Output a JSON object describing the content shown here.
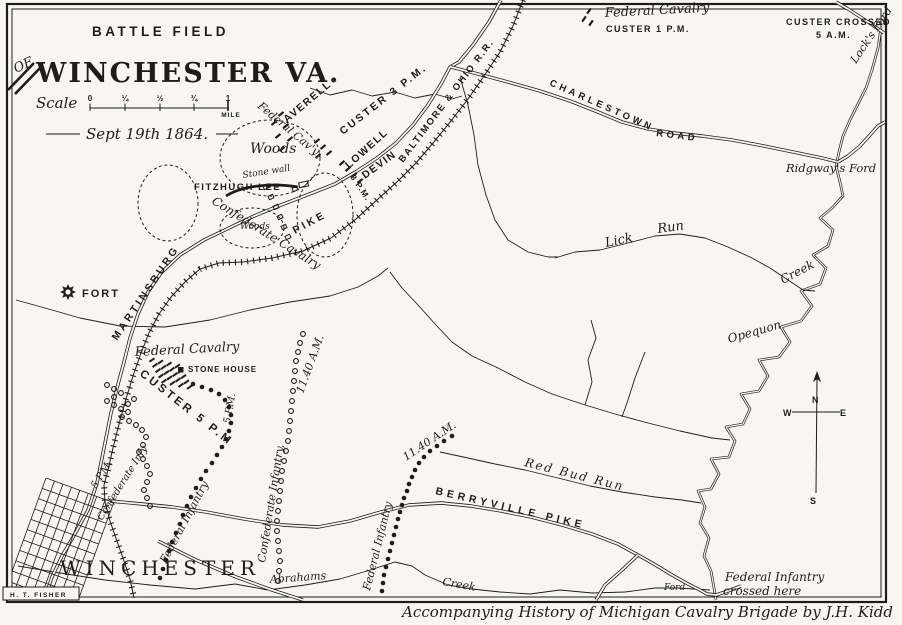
{
  "colors": {
    "ink": "#1e1d19",
    "paper": "#f7f6f1"
  },
  "scale": {
    "word": "Scale",
    "ticks": [
      "0",
      "¼",
      "½",
      "¾",
      "1"
    ],
    "unit": "MILE",
    "date": "Sept 19th 1864."
  },
  "compass": {
    "n": "N",
    "e": "E",
    "s": "S",
    "w": "W"
  },
  "map_labels": {
    "header": [
      {
        "id": "title-battle-field",
        "t": "BATTLE FIELD",
        "x": 92,
        "y": 36,
        "c": "cap",
        "s": 13.5,
        "ls": 3.5
      },
      {
        "id": "title-of",
        "t": "OF",
        "x": 16,
        "y": 73,
        "r": -25,
        "c": "scr",
        "s": 13
      },
      {
        "id": "title-winchester-va",
        "t": "WINCHESTER VA.",
        "x": 36,
        "y": 82,
        "c": "ornate",
        "s": 27,
        "ls": 2
      }
    ],
    "top_right": [
      {
        "id": "federal-cavalry-1pm",
        "t": "Federal Cavalry",
        "x": 605,
        "y": 17,
        "r": -3,
        "c": "scr",
        "s": 13
      },
      {
        "id": "custer-1pm",
        "t": "CUSTER  1 P.M.",
        "x": 606,
        "y": 32,
        "c": "cap",
        "s": 9,
        "ls": 1.5
      },
      {
        "id": "custer-crossed",
        "t": "CUSTER CROSSED",
        "x": 786,
        "y": 25,
        "c": "cap",
        "s": 9,
        "ls": 1.5
      },
      {
        "id": "custer-crossed-time",
        "t": "5 A.M.",
        "x": 816,
        "y": 38,
        "c": "cap",
        "s": 9,
        "ls": 1.5
      },
      {
        "id": "locks-ford",
        "t": "Lock's Ford",
        "x": 856,
        "y": 64,
        "r": -56,
        "c": "scr",
        "s": 11
      }
    ],
    "roads": [
      {
        "id": "charlestown",
        "t": "CHARLESTOWN",
        "x": 549,
        "y": 85,
        "r": 24,
        "c": "cap",
        "s": 9.5,
        "ls": 3.5
      },
      {
        "id": "charlestown-road",
        "t": "ROAD",
        "x": 656,
        "y": 136,
        "r": 7,
        "c": "cap",
        "s": 9.5,
        "ls": 3.5
      },
      {
        "id": "ridgways-ford",
        "t": "Ridgway's Ford",
        "x": 786,
        "y": 172,
        "c": "scr",
        "s": 11.5
      },
      {
        "id": "baltimore-ohio-rr",
        "t": "BALTIMORE & OHIO R.R.",
        "x": 403,
        "y": 163,
        "r": -53,
        "c": "cap",
        "s": 9.5,
        "ls": 1.8
      },
      {
        "id": "martinsburg",
        "t": "MARTINSBURG",
        "x": 117,
        "y": 341,
        "r": -56,
        "c": "cap",
        "s": 10.5,
        "ls": 3
      },
      {
        "id": "pike",
        "t": "PIKE",
        "x": 295,
        "y": 234,
        "r": -28,
        "c": "cap",
        "s": 10.5,
        "ls": 3
      },
      {
        "id": "berryville-pike",
        "t": "BERRYVILLE  PIKE",
        "x": 435,
        "y": 494,
        "r": 13,
        "c": "cap",
        "s": 10.5,
        "ls": 4
      }
    ],
    "federal_positions": [
      {
        "id": "custer-3pm",
        "t": "CUSTER 3 P.M.",
        "x": 343,
        "y": 135,
        "r": -38,
        "c": "cap",
        "s": 10.5,
        "ls": 2.5
      },
      {
        "id": "averell",
        "t": "AVERELL",
        "x": 287,
        "y": 123,
        "r": -40,
        "c": "cap",
        "s": 10.5,
        "ls": 1.5
      },
      {
        "id": "federal-cavy",
        "t": "Federal Cav'y",
        "x": 257,
        "y": 107,
        "r": 40,
        "c": "scr",
        "s": 11
      },
      {
        "id": "lowell",
        "t": "LOWELL",
        "x": 349,
        "y": 169,
        "r": -42,
        "c": "cap",
        "s": 10.5,
        "ls": 1.5
      },
      {
        "id": "devin",
        "t": "DEVIN",
        "x": 365,
        "y": 179,
        "r": -36,
        "c": "cap",
        "s": 10.5,
        "ls": 1.5
      },
      {
        "id": "three-pm",
        "t": "3 P.M.",
        "x": 350,
        "y": 177,
        "r": 56,
        "c": "cap",
        "s": 8.5,
        "ls": 1
      },
      {
        "id": "federal-cavalry-5pm",
        "t": "Federal Cavalry",
        "x": 135,
        "y": 356,
        "r": -3,
        "c": "scr",
        "s": 13
      },
      {
        "id": "custer-5pm",
        "t": "CUSTER 5 P.M",
        "x": 139,
        "y": 375,
        "r": 38,
        "c": "cap",
        "s": 11.5,
        "ls": 3
      },
      {
        "id": "fed-5pm-time",
        "t": "5 P.M.",
        "x": 230,
        "y": 424,
        "r": -80,
        "c": "scr",
        "s": 10
      },
      {
        "id": "fed-inf-5pm",
        "t": "Federal Infantry",
        "x": 166,
        "y": 564,
        "r": -62,
        "c": "scr",
        "s": 11
      },
      {
        "id": "fed-inf-1140",
        "t": "Federal Infantry",
        "x": 370,
        "y": 591,
        "r": -76,
        "c": "scr",
        "s": 11
      },
      {
        "id": "fed-1140-time",
        "t": "11.40 A.M.",
        "x": 406,
        "y": 461,
        "r": -34,
        "c": "scr",
        "s": 11
      },
      {
        "id": "fed-crossed-1",
        "t": "Federal Infantry",
        "x": 725,
        "y": 581,
        "c": "scr",
        "s": 12
      },
      {
        "id": "fed-crossed-2",
        "t": "crossed here",
        "x": 723,
        "y": 595,
        "c": "scr",
        "s": 12
      }
    ],
    "confederate_positions": [
      {
        "id": "fitzhugh-lee",
        "t": "FITZHUGH LEE",
        "x": 194,
        "y": 190,
        "c": "cap",
        "s": 9.5,
        "ls": 1.5
      },
      {
        "id": "confederate-cavalry",
        "t": "Confederate Cavalry",
        "x": 211,
        "y": 203,
        "r": 32,
        "c": "scr",
        "s": 12
      },
      {
        "id": "conf-5pm-time",
        "t": "5 P.M.",
        "x": 96,
        "y": 489,
        "r": -58,
        "c": "scr",
        "s": 10
      },
      {
        "id": "conf-5pm",
        "t": "Confederate Infy",
        "x": 102,
        "y": 521,
        "r": -58,
        "c": "scr",
        "s": 10
      },
      {
        "id": "conf-inf-1140",
        "t": "Confederate Infantry,",
        "x": 265,
        "y": 563,
        "r": -81,
        "c": "scr",
        "s": 11
      },
      {
        "id": "conf-1140-time",
        "t": "11.40 A.M.",
        "x": 303,
        "y": 394,
        "r": -70,
        "c": "scr",
        "s": 11
      }
    ],
    "terrain": [
      {
        "id": "woods-upper",
        "t": "Woods",
        "x": 250,
        "y": 153,
        "c": "scr",
        "s": 14
      },
      {
        "id": "stone-wall",
        "t": "Stone wall",
        "x": 243,
        "y": 178,
        "r": -9,
        "c": "scr",
        "s": 9
      },
      {
        "id": "woods-small",
        "t": "Woods",
        "x": 240,
        "y": 229,
        "c": "scr",
        "s": 9
      },
      {
        "id": "stone-house",
        "t": "STONE HOUSE",
        "x": 188,
        "y": 372,
        "c": "cap",
        "s": 8,
        "ls": 1
      },
      {
        "id": "fort",
        "t": "FORT",
        "x": 82,
        "y": 297,
        "c": "cap",
        "s": 11,
        "ls": 2
      },
      {
        "id": "lick",
        "t": "Lick",
        "x": 606,
        "y": 247,
        "r": -12,
        "c": "scr",
        "s": 13
      },
      {
        "id": "run",
        "t": "Run",
        "x": 658,
        "y": 233,
        "r": -8,
        "c": "scr",
        "s": 13
      },
      {
        "id": "creek-lick",
        "t": "Creek",
        "x": 783,
        "y": 284,
        "r": -28,
        "c": "scr",
        "s": 12
      },
      {
        "id": "opequon",
        "t": "Opequon",
        "x": 729,
        "y": 343,
        "r": -16,
        "c": "scr",
        "s": 12
      },
      {
        "id": "red-bud-run",
        "t": "Red Bud Run",
        "x": 524,
        "y": 466,
        "r": 14,
        "c": "scr",
        "s": 12,
        "ls": 2
      },
      {
        "id": "abrahams",
        "t": "Abrahams",
        "x": 270,
        "y": 583,
        "r": -4,
        "c": "scr",
        "s": 11
      },
      {
        "id": "creek-abrahams",
        "t": "Creek",
        "x": 442,
        "y": 585,
        "r": 10,
        "c": "scr",
        "s": 11
      },
      {
        "id": "ford-bottom",
        "t": "Ford",
        "x": 664,
        "y": 590,
        "c": "scr",
        "s": 9
      },
      {
        "id": "winchester-town",
        "t": "WINCHESTER",
        "x": 60,
        "y": 575,
        "c": "town",
        "s": 20,
        "ls": 5
      }
    ],
    "footer": [
      {
        "id": "fisher",
        "t": "H. T. FISHER",
        "x": 10,
        "y": 597,
        "c": "cap",
        "s": 6.5,
        "ls": 1.5
      },
      {
        "id": "caption",
        "t": "Accompanying History of  Michigan Cavalry Brigade by J.H. Kidd",
        "x": 893,
        "y": 617,
        "c": "scr",
        "s": 15,
        "a": "end"
      }
    ]
  }
}
